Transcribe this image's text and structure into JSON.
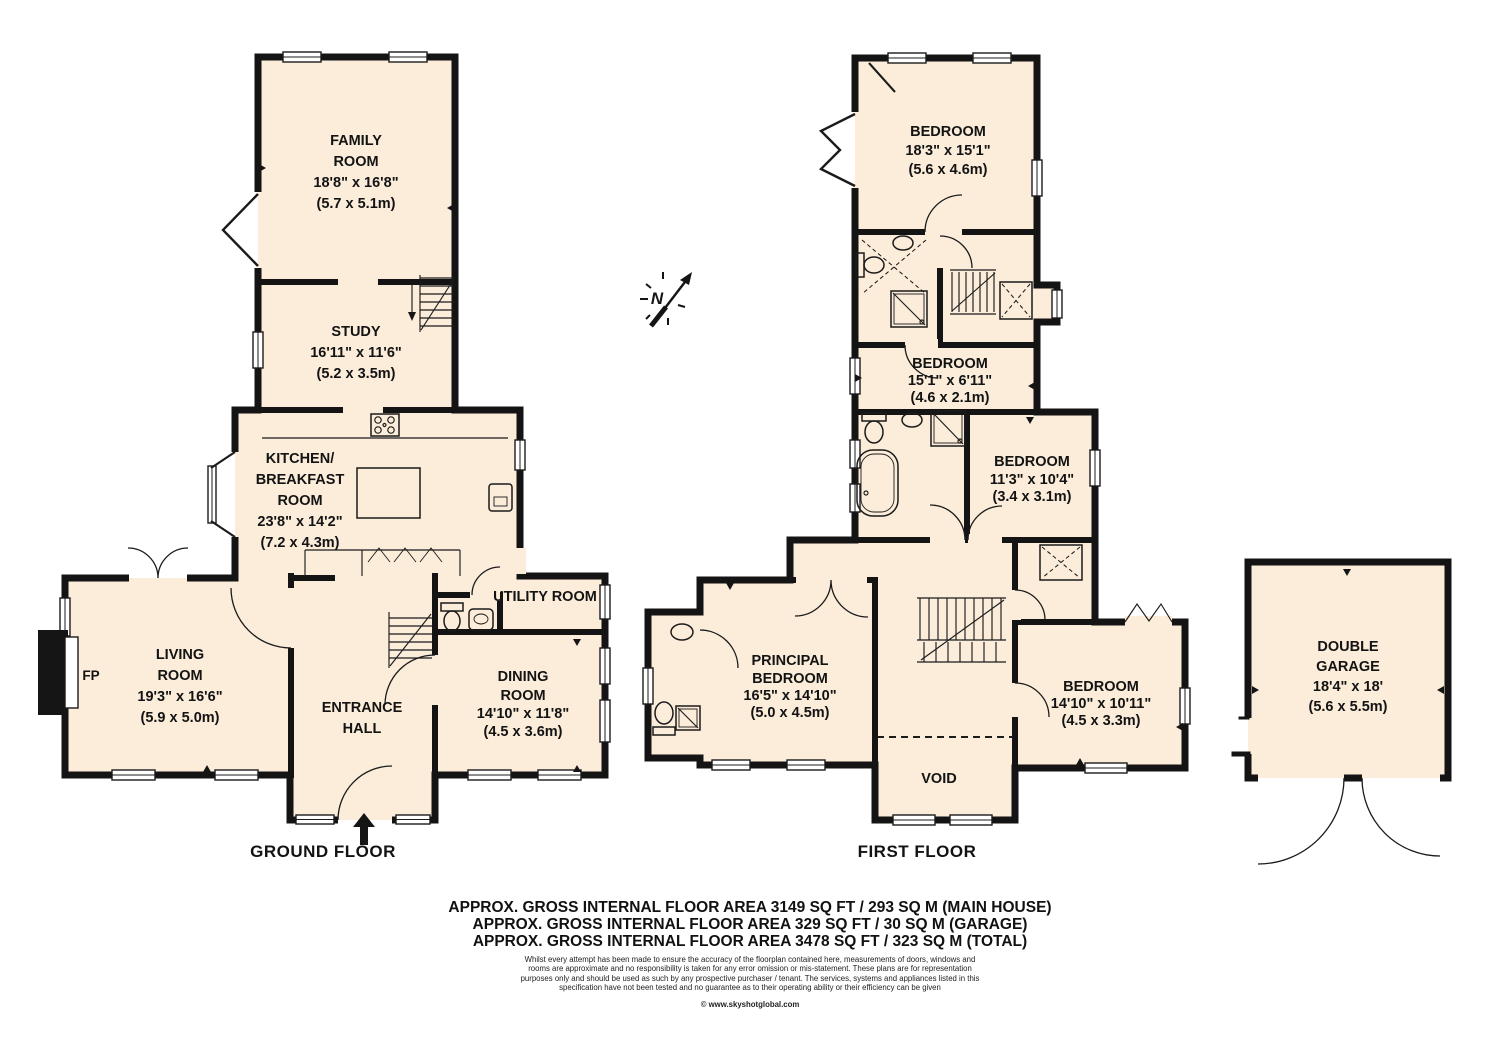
{
  "colors": {
    "room_fill": "#FBEDDA",
    "wall": "#141414",
    "page_bg": "#FFFFFF"
  },
  "compass": {
    "letter": "N"
  },
  "ground_floor": {
    "caption": "GROUND FLOOR",
    "family_room": {
      "name1": "FAMILY",
      "name2": "ROOM",
      "dims_ft": "18'8\" x 16'8\"",
      "dims_m": "(5.7 x 5.1m)"
    },
    "study": {
      "name": "STUDY",
      "dims_ft": "16'11\" x 11'6\"",
      "dims_m": "(5.2 x 3.5m)"
    },
    "kitchen": {
      "name1": "KITCHEN/",
      "name2": "BREAKFAST",
      "name3": "ROOM",
      "dims_ft": "23'8\" x 14'2\"",
      "dims_m": "(7.2 x 4.3m)"
    },
    "living_room": {
      "name1": "LIVING",
      "name2": "ROOM",
      "dims_ft": "19'3\" x 16'6\"",
      "dims_m": "(5.9 x 5.0m)"
    },
    "entrance_hall": {
      "name1": "ENTRANCE",
      "name2": "HALL"
    },
    "dining_room": {
      "name1": "DINING",
      "name2": "ROOM",
      "dims_ft": "14'10\" x 11'8\"",
      "dims_m": "(4.5 x 3.6m)"
    },
    "utility_room": {
      "name": "UTILITY ROOM"
    },
    "fireplace": {
      "label": "FP"
    }
  },
  "first_floor": {
    "caption": "FIRST FLOOR",
    "bedroom_top": {
      "name": "BEDROOM",
      "dims_ft": "18'3\" x 15'1\"",
      "dims_m": "(5.6 x 4.6m)"
    },
    "bedroom_middle": {
      "name": "BEDROOM",
      "dims_ft": "15'1\" x 6'11\"",
      "dims_m": "(4.6 x 2.1m)"
    },
    "bedroom_small": {
      "name": "BEDROOM",
      "dims_ft": "11'3\" x 10'4\"",
      "dims_m": "(3.4 x 3.1m)"
    },
    "principal_bedroom": {
      "name1": "PRINCIPAL",
      "name2": "BEDROOM",
      "dims_ft": "16'5\" x 14'10\"",
      "dims_m": "(5.0 x 4.5m)"
    },
    "bedroom_right": {
      "name": "BEDROOM",
      "dims_ft": "14'10\" x 10'11\"",
      "dims_m": "(4.5 x 3.3m)"
    },
    "void": {
      "name": "VOID"
    }
  },
  "garage": {
    "double_garage": {
      "name1": "DOUBLE",
      "name2": "GARAGE",
      "dims_ft": "18'4\" x 18'",
      "dims_m": "(5.6 x 5.5m)"
    }
  },
  "footer": {
    "area_lines": [
      "APPROX. GROSS INTERNAL FLOOR AREA 3149 SQ FT / 293 SQ M (MAIN HOUSE)",
      "APPROX. GROSS INTERNAL FLOOR AREA 329 SQ FT / 30 SQ M (GARAGE)",
      "APPROX. GROSS INTERNAL FLOOR AREA 3478 SQ FT / 323 SQ M (TOTAL)"
    ],
    "disclaimer_lines": [
      "Whilst every attempt has been made to ensure the accuracy of the floorplan contained here, measurements of doors, windows and",
      "rooms are approximate and no responsibility is taken for any error omission or mis-statement. These plans are for representation",
      "purposes only and should  be used as such by any prospective purchaser / tenant. The services, systems and appliances listed in this",
      "specification have not been tested and no guarantee as to their operating ability or their efficiency can be given"
    ],
    "copyright": "© www.skyshotglobal.com"
  }
}
